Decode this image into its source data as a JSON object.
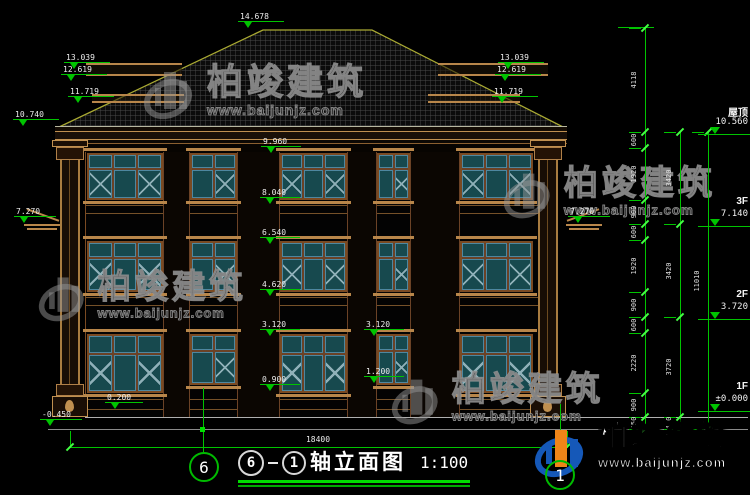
{
  "drawing_title": {
    "axis_start": "6",
    "axis_end": "1",
    "name": "轴立面图",
    "scale": "1:100"
  },
  "bottom_dimension": "18400",
  "axis_bubbles": {
    "left": "6",
    "right": "1"
  },
  "floor_labels": [
    {
      "name": "屋顶",
      "value": "10.560",
      "y": 104,
      "line_y": 134
    },
    {
      "name": "3F",
      "value": "7.140",
      "y": 196,
      "line_y": 226
    },
    {
      "name": "2F",
      "value": "3.720",
      "y": 289,
      "line_y": 319
    },
    {
      "name": "1F",
      "value": "±0.000",
      "y": 381,
      "line_y": 411
    }
  ],
  "level_markers": [
    {
      "t": "14.678",
      "x": 240,
      "y": 12,
      "w": 40
    },
    {
      "t": "13.039",
      "x": 66,
      "y": 53,
      "w": 40
    },
    {
      "t": "12.619",
      "x": 63,
      "y": 65,
      "w": 40
    },
    {
      "t": "11.719",
      "x": 70,
      "y": 87,
      "w": 40
    },
    {
      "t": "10.740",
      "x": 15,
      "y": 110,
      "w": 40
    },
    {
      "t": "7.270",
      "x": 16,
      "y": 207,
      "w": 36
    },
    {
      "t": "9.960",
      "x": 263,
      "y": 137,
      "w": 34
    },
    {
      "t": "8.040",
      "x": 262,
      "y": 188,
      "w": 34
    },
    {
      "t": "6.540",
      "x": 262,
      "y": 228,
      "w": 34
    },
    {
      "t": "4.620",
      "x": 262,
      "y": 280,
      "w": 34
    },
    {
      "t": "3.120",
      "x": 262,
      "y": 320,
      "w": 34
    },
    {
      "t": "0.900",
      "x": 262,
      "y": 375,
      "w": 34
    },
    {
      "t": "3.120",
      "x": 366,
      "y": 320,
      "w": 34
    },
    {
      "t": "1.200",
      "x": 366,
      "y": 367,
      "w": 34
    },
    {
      "t": "0.200",
      "x": 107,
      "y": 393,
      "w": 32
    },
    {
      "t": "-0.450",
      "x": 42,
      "y": 410,
      "w": 36
    },
    {
      "t": "13.039",
      "x": 500,
      "y": 53,
      "w": 40
    },
    {
      "t": "12.619",
      "x": 497,
      "y": 65,
      "w": 40
    },
    {
      "t": "11.719",
      "x": 494,
      "y": 87,
      "w": 40
    },
    {
      "t": "7.270",
      "x": 570,
      "y": 207,
      "w": 36
    }
  ],
  "right_dimensions": {
    "columns": [
      {
        "x": 645,
        "segments": [
          [
            "4118",
            28,
            132
          ],
          [
            "600",
            132,
            148
          ],
          [
            "1920",
            148,
            200
          ],
          [
            "900",
            200,
            224
          ],
          [
            "600",
            224,
            240
          ],
          [
            "1920",
            240,
            292
          ],
          [
            "900",
            292,
            317
          ],
          [
            "600",
            317,
            333
          ],
          [
            "2220",
            333,
            393
          ],
          [
            "900",
            393,
            417
          ],
          [
            "450",
            417,
            429
          ]
        ]
      },
      {
        "x": 680,
        "segments": [
          [
            "3420",
            132,
            224
          ],
          [
            "3420",
            224,
            317
          ],
          [
            "3720",
            317,
            417
          ],
          [
            "450",
            417,
            429
          ]
        ]
      },
      {
        "x": 708,
        "segments": [
          [
            "11010",
            132,
            429
          ]
        ]
      }
    ]
  },
  "watermark": {
    "company": "柏竣建筑",
    "website": "www.baijunjz.com"
  },
  "colors": {
    "dimension_green": "#00c400",
    "tick_green": "#44ff44",
    "text_white": "#ededed",
    "building_tan": "#c09050",
    "building_brown": "#6b4226",
    "window_teal": "#17494e",
    "window_frame_blue": "#4e87a0",
    "roof_outline": "#aaaa33",
    "logo_blue": "#1558b8",
    "logo_orange": "#f08518"
  }
}
